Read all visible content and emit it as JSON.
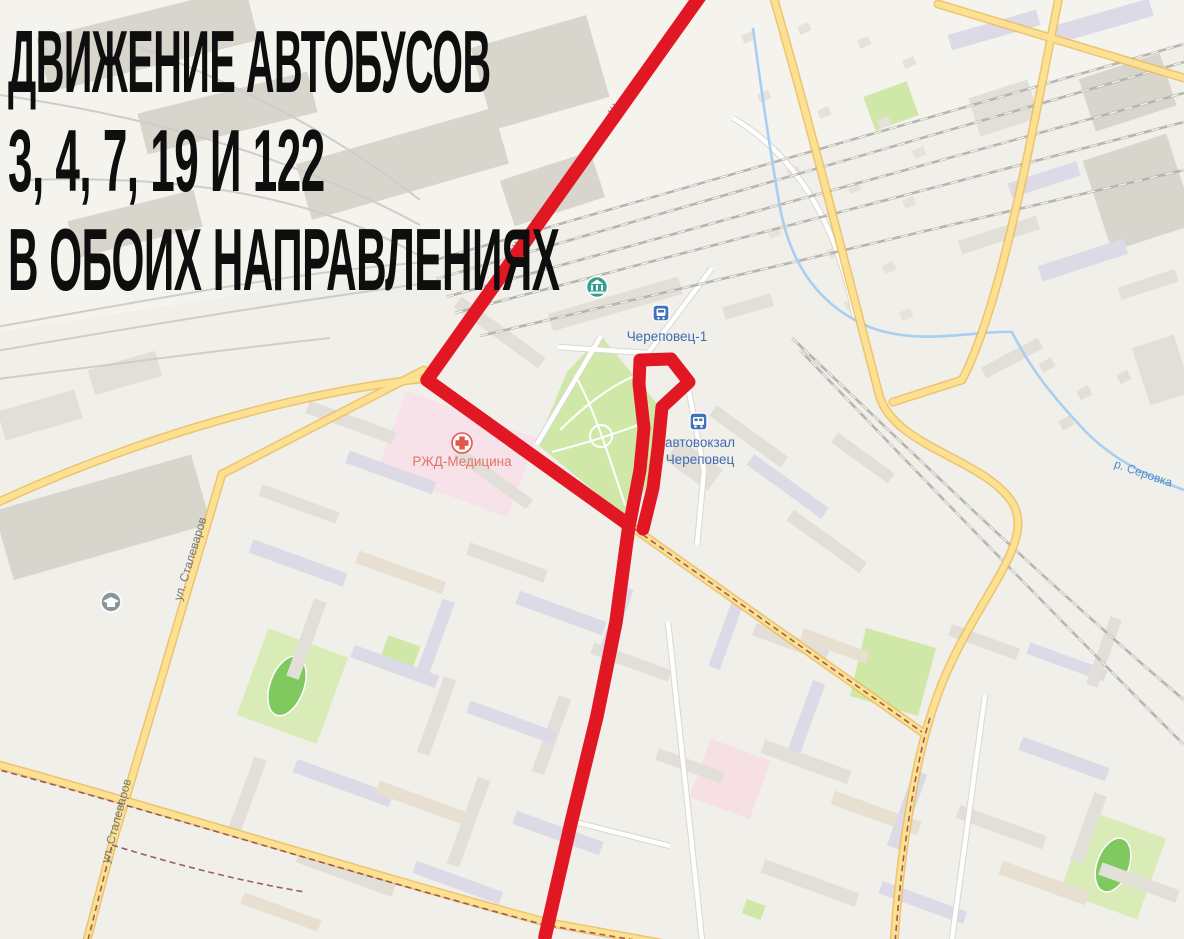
{
  "poster": {
    "title_line1": "Движение автобусов",
    "title_line2": "3, 4, 7, 19 и 122",
    "title_line3": "в обоих направлениях"
  },
  "map": {
    "labels": {
      "railway_station": "Череповец-1",
      "bus_station_line1": "автовокзал",
      "bus_station_line2": "Череповец",
      "clinic": "РЖД-Медицина",
      "street_shkolnaya": "Школьная ул.",
      "street_stalevarov": "ул. Сталеваров",
      "river": "р. Серовка"
    },
    "icons": {
      "railway_station_icon": "train-icon",
      "bus_station_icon": "bus-icon",
      "museum_icon": "museum-icon",
      "clinic_icon": "medical-cross-icon",
      "school_icon": "school-icon"
    },
    "colors": {
      "route_red": "#e11723",
      "road_yellow": "#fbe191",
      "road_casing": "#ecba52",
      "park_green": "#cfe8a8",
      "stadium_green": "#7fc95e",
      "water_blue": "#a8cff0",
      "railway_gray": "#b7b5b0",
      "tram_line": "#8d4553",
      "poi_label_blue": "#3d6cb0",
      "clinic_label_red": "#e0746b",
      "street_label_gray": "#767676",
      "title_black": "#0e0e0e"
    }
  },
  "route": {
    "note_direction": "both directions",
    "shape": "School st → turn at park → terminal loop at bus station → south"
  }
}
